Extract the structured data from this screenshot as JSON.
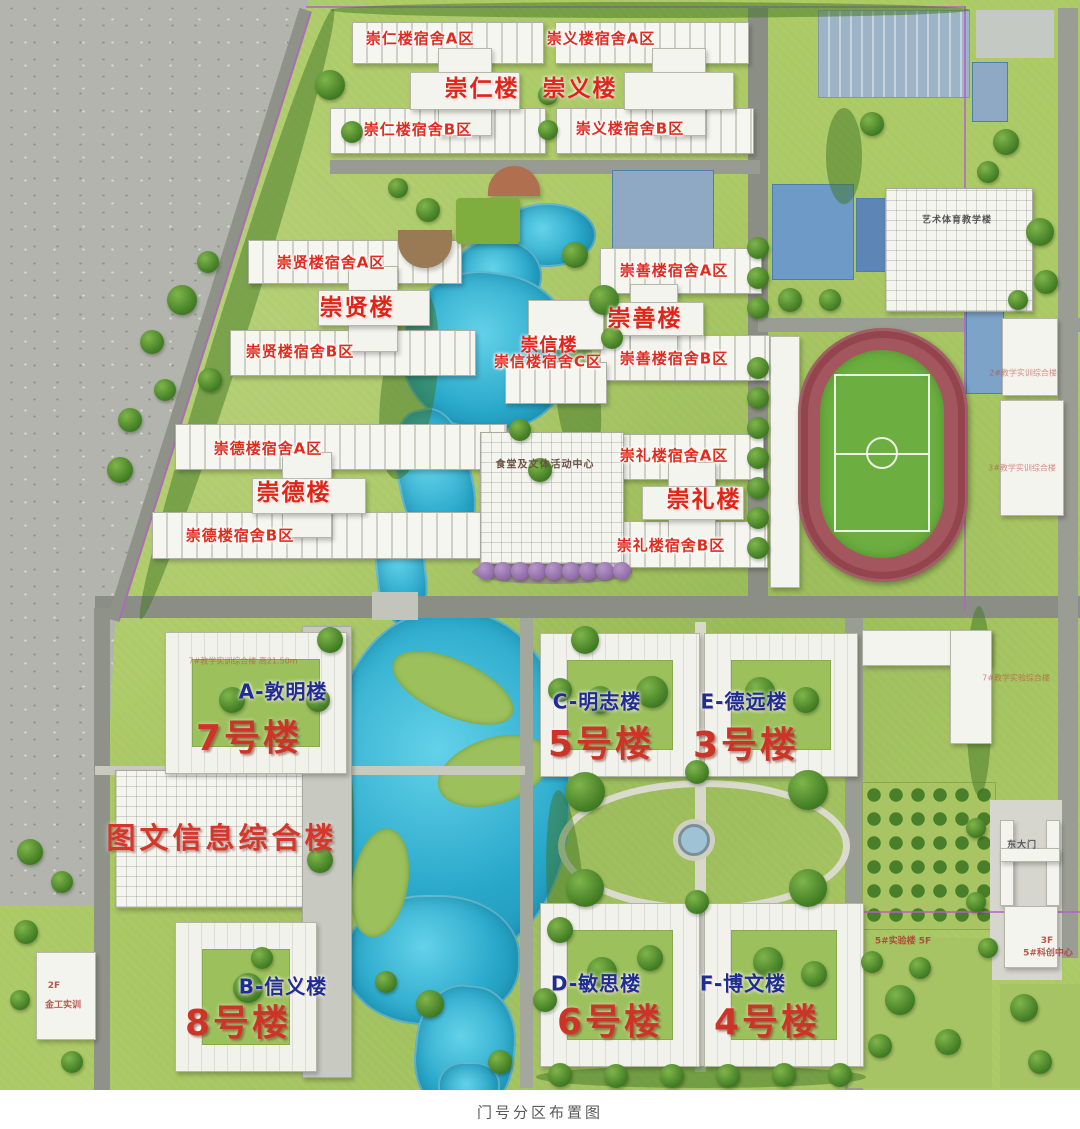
{
  "caption": "门号分区布置图",
  "palette": {
    "water": "#2fb0d0",
    "lawn": "#abc964",
    "track": "#a4565f",
    "field_green": "#6cae40",
    "label_red": "#d8251d",
    "label_navy": "#1d2d91",
    "boundary_purple": "#b55fc6"
  },
  "labels": [
    {
      "id": "chongren-dorm-a",
      "text": "崇仁楼宿舍A区",
      "style": "st-dorm",
      "x": 420,
      "y": 38
    },
    {
      "id": "chongyi-dorm-a",
      "text": "崇义楼宿舍A区",
      "style": "st-dorm",
      "x": 601,
      "y": 38
    },
    {
      "id": "chongren-dorm-b",
      "text": "崇仁楼宿舍B区",
      "style": "st-dorm",
      "x": 418,
      "y": 129
    },
    {
      "id": "chongyi-dorm-b",
      "text": "崇义楼宿舍B区",
      "style": "st-dorm",
      "x": 630,
      "y": 128
    },
    {
      "id": "chongxian-dorm-a",
      "text": "崇贤楼宿舍A区",
      "style": "st-dorm",
      "x": 331,
      "y": 262
    },
    {
      "id": "chongxian-dorm-b",
      "text": "崇贤楼宿舍B区",
      "style": "st-dorm",
      "x": 300,
      "y": 351
    },
    {
      "id": "chongshan-dorm-a",
      "text": "崇善楼宿舍A区",
      "style": "st-dorm",
      "x": 674,
      "y": 270
    },
    {
      "id": "chongshan-dorm-b",
      "text": "崇善楼宿舍B区",
      "style": "st-dorm",
      "x": 674,
      "y": 358
    },
    {
      "id": "chongxin-dorm-c",
      "text": "崇信楼宿舍C区",
      "style": "st-dorm",
      "x": 548,
      "y": 361
    },
    {
      "id": "chongde-dorm-a",
      "text": "崇德楼宿舍A区",
      "style": "st-dorm",
      "x": 268,
      "y": 448
    },
    {
      "id": "chongde-dorm-b",
      "text": "崇德楼宿舍B区",
      "style": "st-dorm",
      "x": 240,
      "y": 535
    },
    {
      "id": "chongli-dorm-a",
      "text": "崇礼楼宿舍A区",
      "style": "st-dorm",
      "x": 674,
      "y": 455
    },
    {
      "id": "chongli-dorm-b",
      "text": "崇礼楼宿舍B区",
      "style": "st-dorm",
      "x": 671,
      "y": 545
    },
    {
      "id": "chongren-hall",
      "text": "崇仁楼",
      "style": "st-hall",
      "x": 482,
      "y": 86
    },
    {
      "id": "chongyi-hall",
      "text": "崇义楼",
      "style": "st-hall",
      "x": 580,
      "y": 86
    },
    {
      "id": "chongxian-hall",
      "text": "崇贤楼",
      "style": "st-hall",
      "x": 357,
      "y": 305
    },
    {
      "id": "chongshan-hall",
      "text": "崇善楼",
      "style": "st-hall",
      "x": 645,
      "y": 316
    },
    {
      "id": "chongxin-hall",
      "text": "崇信楼",
      "style": "st-hallsm",
      "x": 549,
      "y": 344
    },
    {
      "id": "chongde-hall",
      "text": "崇德楼",
      "style": "st-hall",
      "x": 294,
      "y": 490
    },
    {
      "id": "chongli-hall",
      "text": "崇礼楼",
      "style": "st-hall",
      "x": 704,
      "y": 497
    },
    {
      "id": "bldg-a",
      "text": "A-敦明楼",
      "style": "st-letter",
      "x": 283,
      "y": 690
    },
    {
      "id": "bldg-c",
      "text": "C-明志楼",
      "style": "st-letter",
      "x": 597,
      "y": 700
    },
    {
      "id": "bldg-e",
      "text": "E-德远楼",
      "style": "st-letter",
      "x": 744,
      "y": 700
    },
    {
      "id": "bldg-b",
      "text": "B-信义楼",
      "style": "st-letter",
      "x": 283,
      "y": 985
    },
    {
      "id": "bldg-d",
      "text": "D-敏思楼",
      "style": "st-letter",
      "x": 596,
      "y": 982
    },
    {
      "id": "bldg-f",
      "text": "F-博文楼",
      "style": "st-letter",
      "x": 743,
      "y": 982
    },
    {
      "id": "no7",
      "text": "7号楼",
      "style": "st-num",
      "x": 249,
      "y": 735
    },
    {
      "id": "no5",
      "text": "5号楼",
      "style": "st-num",
      "x": 601,
      "y": 741
    },
    {
      "id": "no3",
      "text": "3号楼",
      "style": "st-num",
      "x": 746,
      "y": 742
    },
    {
      "id": "no8",
      "text": "8号楼",
      "style": "st-num",
      "x": 238,
      "y": 1020
    },
    {
      "id": "no6",
      "text": "6号楼",
      "style": "st-num",
      "x": 610,
      "y": 1019
    },
    {
      "id": "no4",
      "text": "4号楼",
      "style": "st-num",
      "x": 767,
      "y": 1019
    },
    {
      "id": "library",
      "text": "图文信息综合楼",
      "style": "st-lib",
      "x": 222,
      "y": 836
    },
    {
      "id": "canteen",
      "text": "食堂及文体活动中心",
      "style": "st-tinydark",
      "x": 545,
      "y": 463
    },
    {
      "id": "art-sports",
      "text": "艺术体育教学楼",
      "style": "st-tinygray",
      "x": 957,
      "y": 219
    },
    {
      "id": "east-gate",
      "text": "东大门",
      "style": "st-tinygray",
      "x": 1022,
      "y": 844
    },
    {
      "id": "metal-floor",
      "text": "2F",
      "style": "st-tinyred",
      "x": 54,
      "y": 986
    },
    {
      "id": "metal-name",
      "text": "金工实训",
      "style": "st-tinyred",
      "x": 63,
      "y": 1004
    },
    {
      "id": "lab5",
      "text": "5#实验楼 5F",
      "style": "st-tinyred",
      "x": 903,
      "y": 940
    },
    {
      "id": "sci-floor",
      "text": "3F",
      "style": "st-tinyred",
      "x": 1047,
      "y": 941
    },
    {
      "id": "sci-center",
      "text": "5#科创中心",
      "style": "st-tinyred",
      "x": 1048,
      "y": 952
    },
    {
      "id": "annex-right-1",
      "text": "2#教学实训综合楼",
      "style": "st-faint",
      "x": 1023,
      "y": 373
    },
    {
      "id": "annex-right-2",
      "text": "3#教学实训综合楼",
      "style": "st-faint",
      "x": 1022,
      "y": 468
    },
    {
      "id": "no7-annex",
      "text": "7#教学实训综合楼 高21.50m",
      "style": "st-faint",
      "x": 243,
      "y": 661
    },
    {
      "id": "right-annex",
      "text": "7#教学实验综合楼",
      "style": "st-faint",
      "x": 1016,
      "y": 678
    }
  ]
}
